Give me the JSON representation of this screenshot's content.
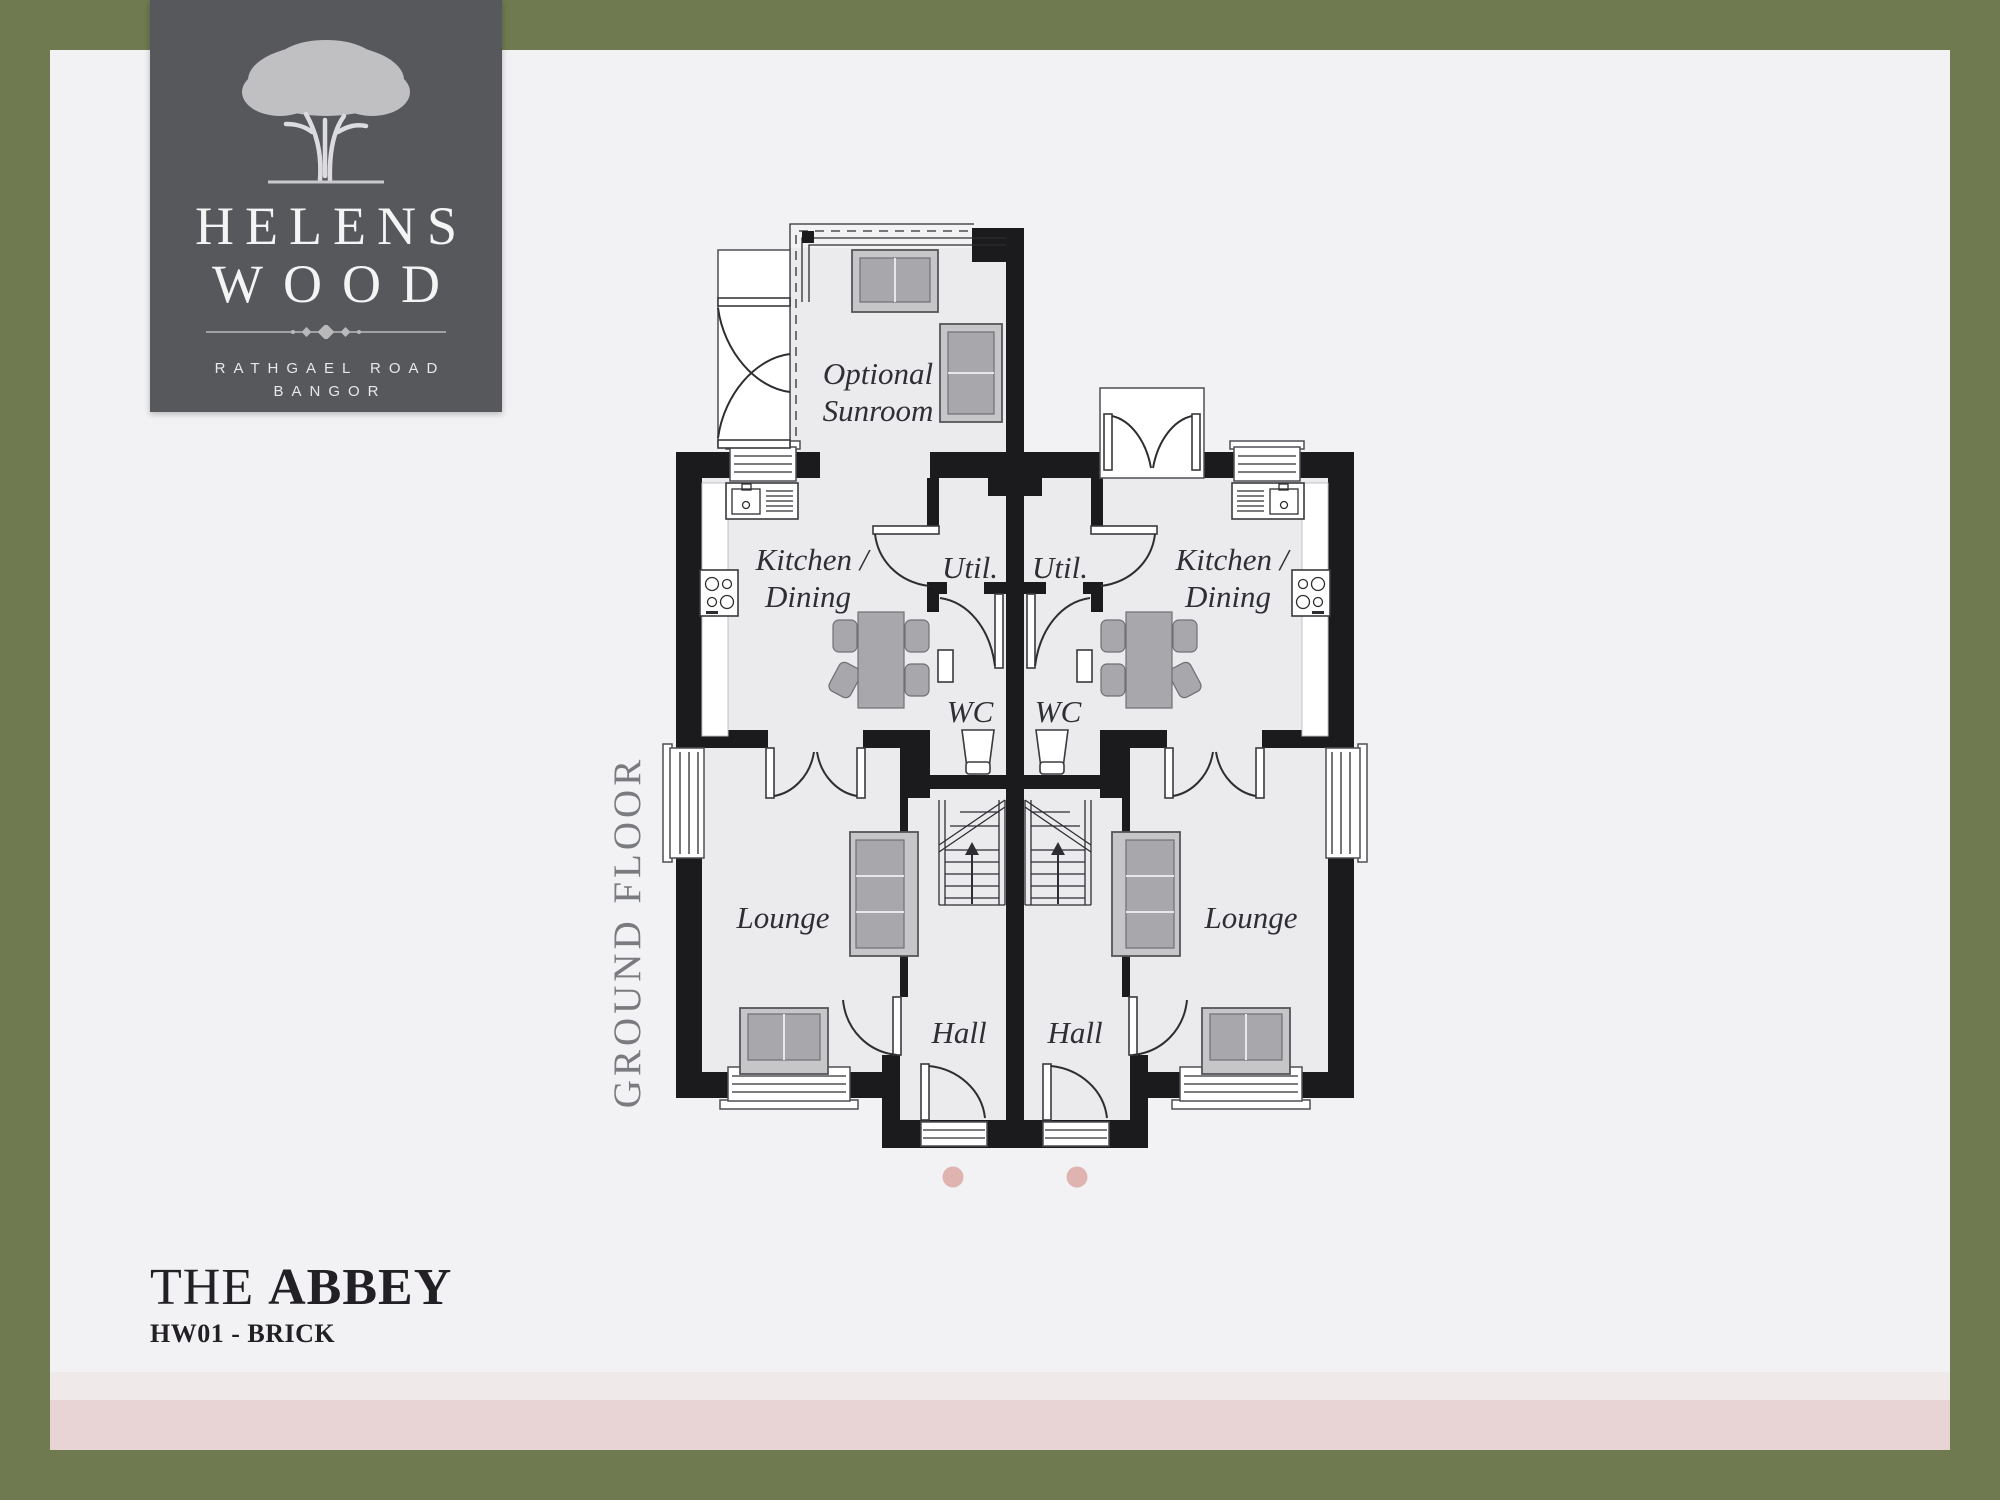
{
  "page": {
    "frame_color": "#6F7A50",
    "background": "#F2F2F4",
    "band_light_color": "#EFE9EA",
    "band_pink_color": "#E8D4D4"
  },
  "logo": {
    "background": "#57585C",
    "tree_icon": "oak-tree",
    "name_line1": "HELENS",
    "name_line2": "WOOD",
    "address_line1": "RATHGAEL ROAD",
    "address_line2": "BANGOR"
  },
  "plan": {
    "floor_label": "GROUND FLOOR",
    "rooms": {
      "sunroom_line1": "Optional",
      "sunroom_line2": "Sunroom",
      "kitchen_line1": "Kitchen /",
      "kitchen_line2": "Dining",
      "util": "Util.",
      "wc": "WC",
      "lounge": "Lounge",
      "hall": "Hall"
    },
    "colors": {
      "wall": "#1B1B1D",
      "room_fill": "#EBEBED",
      "furniture": "#A8A8AC",
      "label": "#2E2F35"
    }
  },
  "pagination": {
    "dot_count": 2,
    "dot_color": "#DFB3AF"
  },
  "footer": {
    "title_regular": "THE",
    "title_bold": "ABBEY",
    "subtitle": "HW01 - BRICK"
  }
}
